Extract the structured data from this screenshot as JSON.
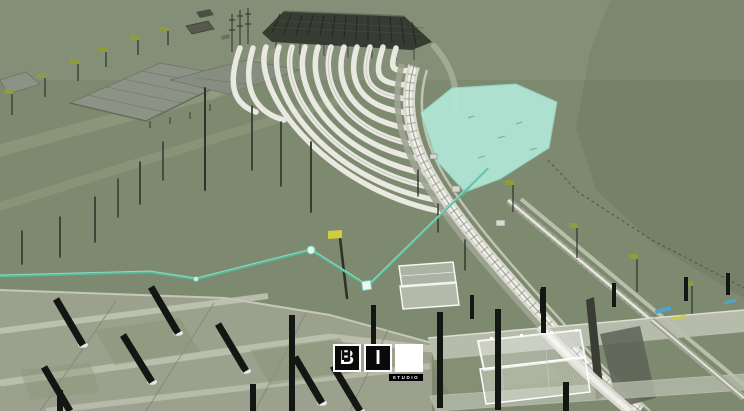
{
  "meta": {
    "width": 744,
    "height": 411,
    "description": "Aerial 3D BIM model render of a railway depot: fanned white tracks under a dark canopy, green terrain, a cyan highlighted pond area, a teal utility polyline with nodes, and a concrete apron foreground with catenary posts"
  },
  "watermark": {
    "tiles": [
      {
        "label": "B"
      },
      {
        "label": "I"
      },
      {
        "label": "M"
      }
    ],
    "subtext": "STUDIO"
  },
  "colors": {
    "terrain": "#7E8A70",
    "terrain_far": "#747E68",
    "road_tint": "#9AA287",
    "building": "#8D9287",
    "building_dark": "#555A4D",
    "canopy": "#34382F",
    "canopy_line": "#1F231C",
    "track_white": "#EFEEE8",
    "ballast": "#D9D9CF",
    "road_gray": "#9FA492",
    "concrete_strip": "#C6CAB9",
    "pond": "#B2E8D7",
    "pond_edge": "#8FD9C2",
    "utility": "#57BFA0",
    "node_fill": "#EAFBF3",
    "apron": "#9BA18D",
    "apron_band": "#C2C6B5",
    "apron_seam": "#7C8271",
    "apron_patch": "#8E9478",
    "post_black": "#141613",
    "post_base": "#E8E9E2",
    "pole_dark": "#2E322B",
    "flag_olive": "#8F9B3C",
    "flag_yellow": "#D3CC3E",
    "glass_fill": "#FFFFFF",
    "glass_edge": "#F6F6F2",
    "platform": "#B9BEAE",
    "fence": "#4A5142",
    "cyan_small": "#4AA7C9",
    "wall_gray": "#5D6156",
    "shadow_dark": "#3A3D35",
    "tile_bg": "#0A0A0A",
    "tile_fg": "#FFFFFF",
    "m_bg": "#FFFFFF",
    "m_fg": "#0A0A0A",
    "strip_bg": "#000000",
    "strip_fg": "#FFFFFF"
  }
}
